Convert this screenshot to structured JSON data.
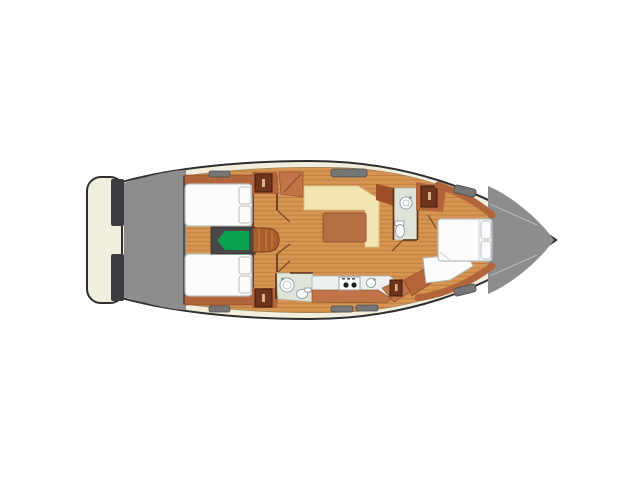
{
  "colors": {
    "background": "#ffffff",
    "hull": "#f1eedd",
    "outline": "#2e2e2e",
    "deck": "#8d8d8d",
    "transom": "#3b3b40",
    "window": "#767676",
    "window_border": "#4e4e4e",
    "floor": "#d69552",
    "floor_line": "#c17f3e",
    "cabinet": "#c07448",
    "cabinet_dark": "#6f341b",
    "trim": "#b2653a",
    "steps": "#a95f2e",
    "bench": "#f3e5b2",
    "table": "#b56f45",
    "bed": "#fcfcfc",
    "bed_outline": "#b7bec5",
    "bathroom": "#dee4d8",
    "fixture": "#ffffff",
    "fixture_outline": "#98a1a9",
    "counter": "#edf0f1",
    "engine_bg": "#47474a",
    "engine": "#09a14e",
    "wall": "#5a3015",
    "seam": "#b5b5b5",
    "burner": "#1e1e1e",
    "handle": "#d8b48a"
  }
}
